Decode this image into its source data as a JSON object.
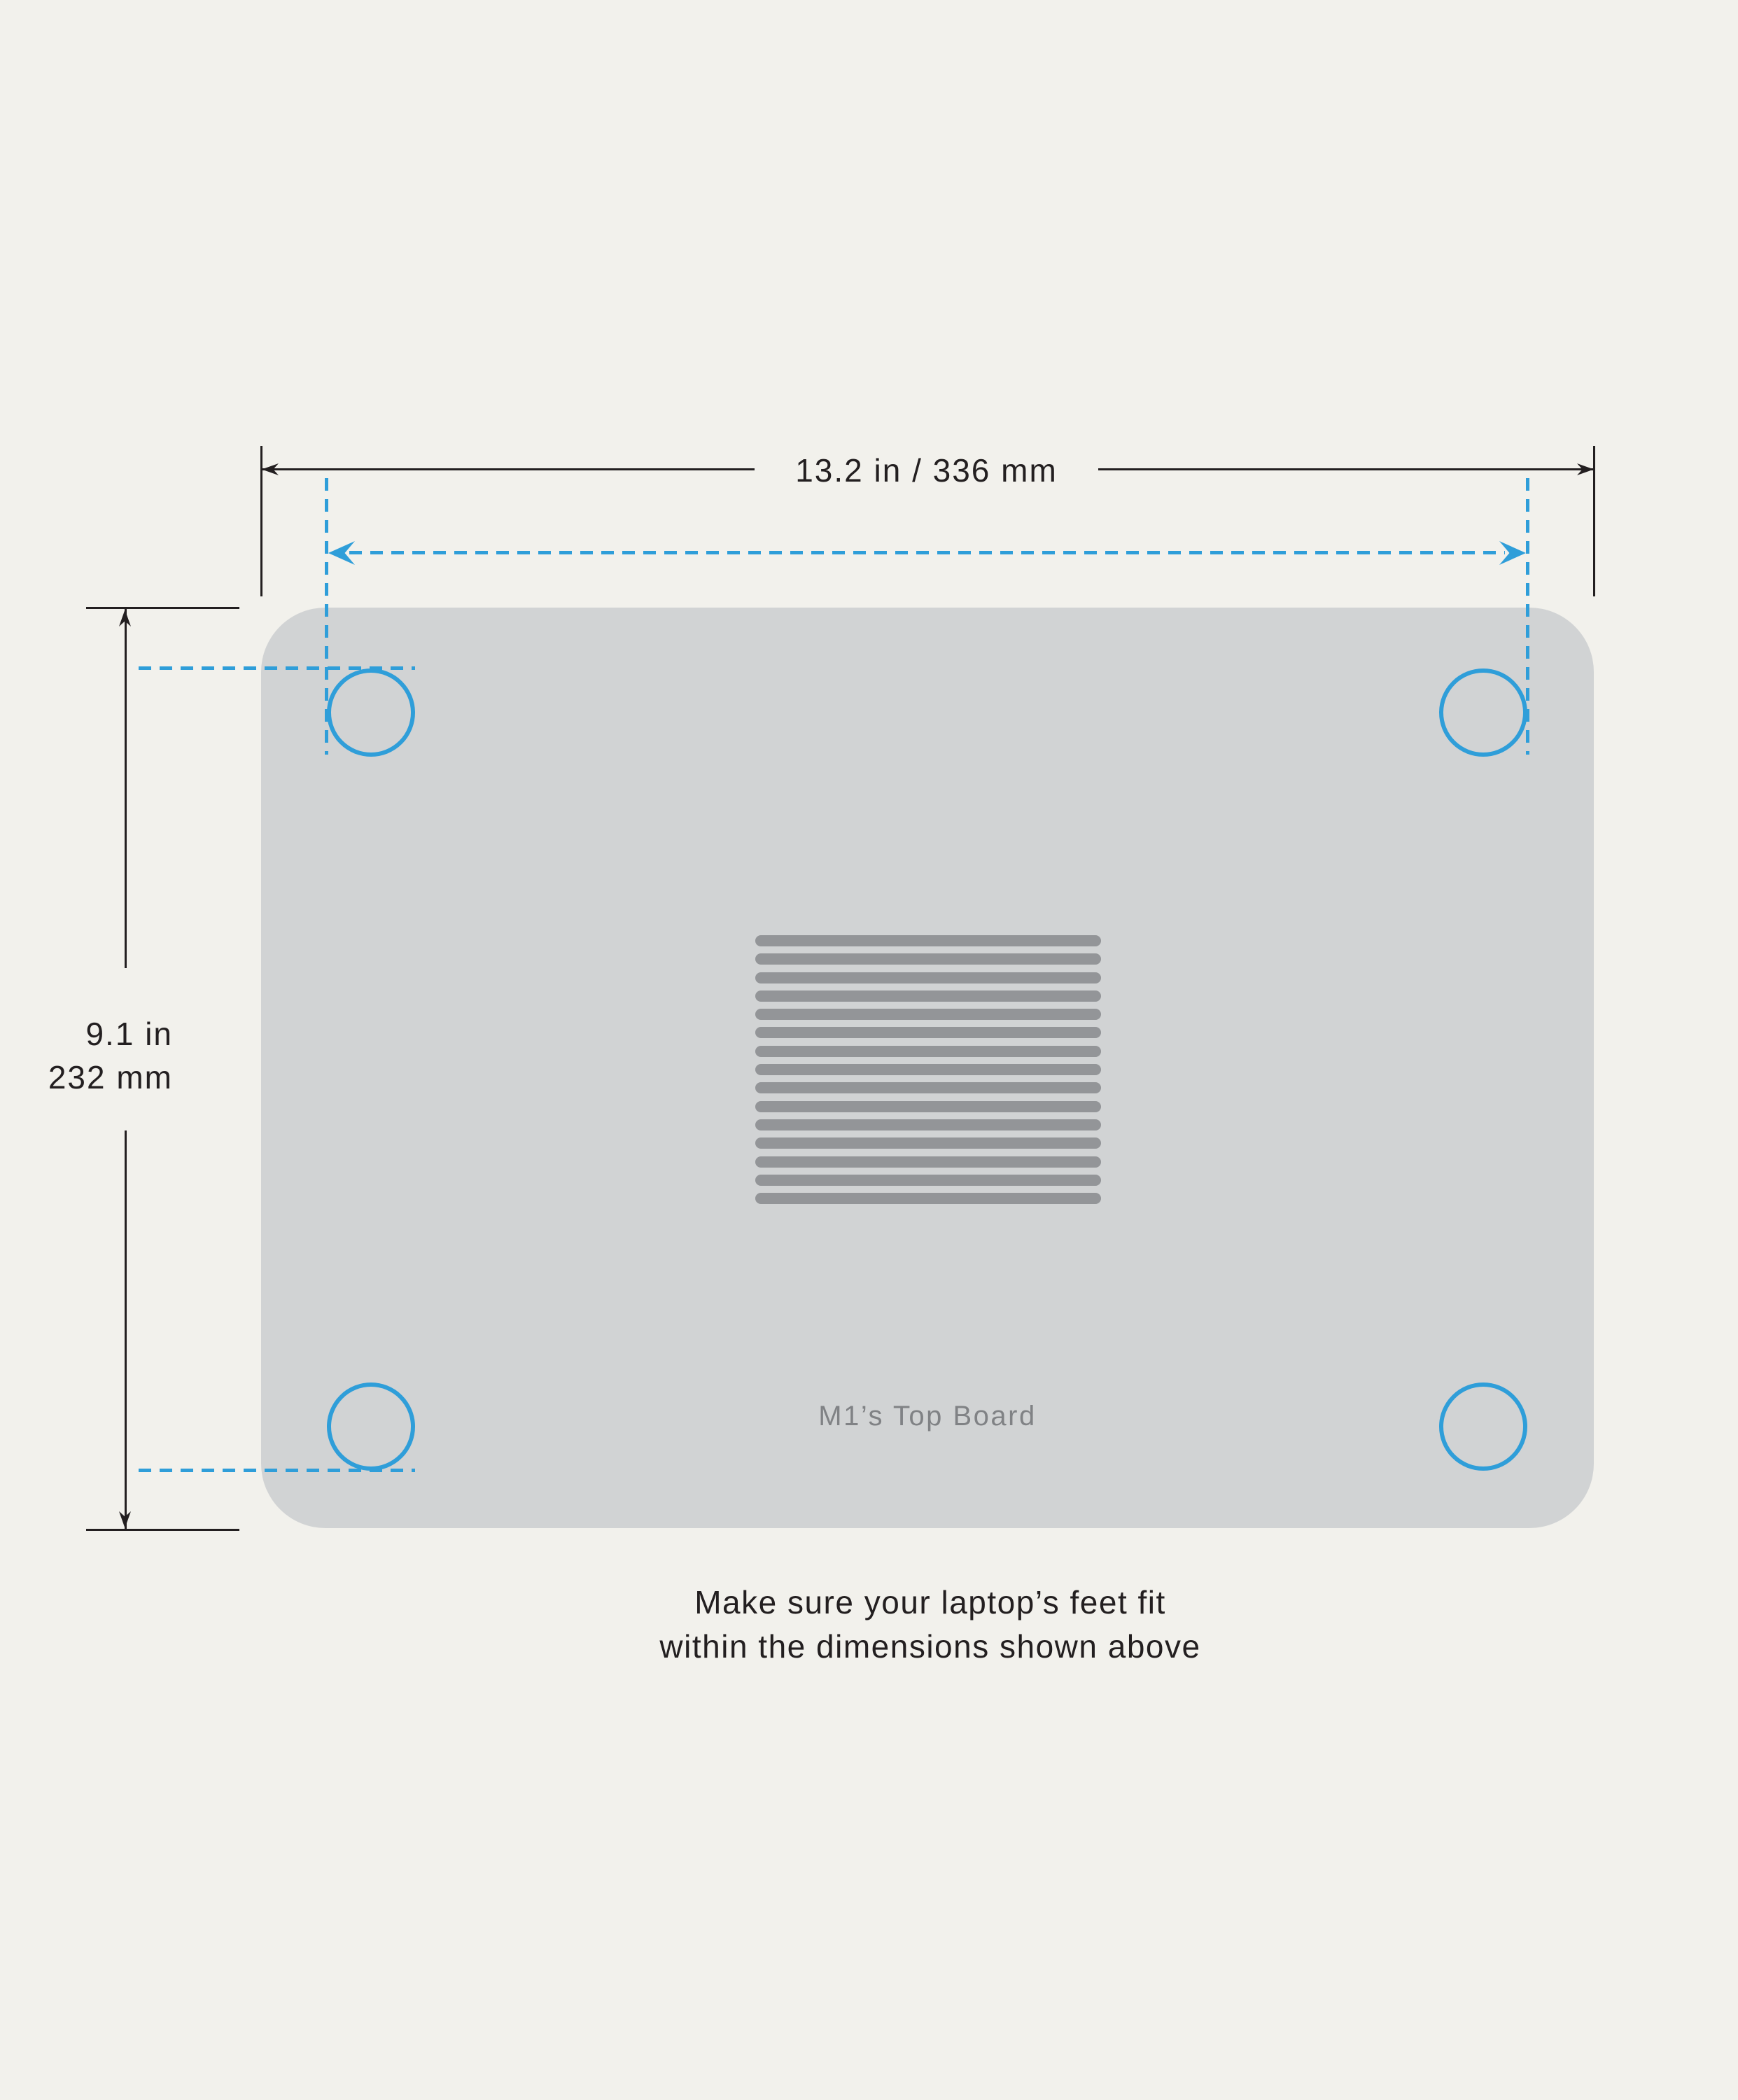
{
  "dimensions": {
    "width": {
      "label": "13.2 in / 336 mm"
    },
    "height": {
      "inches": "9.1 in",
      "millimeters": "232 mm"
    }
  },
  "board": {
    "label": "M1’s Top Board"
  },
  "caption": {
    "line1": "Make sure your laptop’s feet fit",
    "line2": "within the dimensions shown above"
  },
  "vents": {
    "count": 15
  },
  "feet": {
    "count": 4
  },
  "colors": {
    "background": "#f2f1ec",
    "plate": "#d1d3d4",
    "vent": "#939598",
    "accent_blue": "#2f9ed9",
    "line_dark": "#231f20",
    "board_label_gray": "#808285"
  }
}
